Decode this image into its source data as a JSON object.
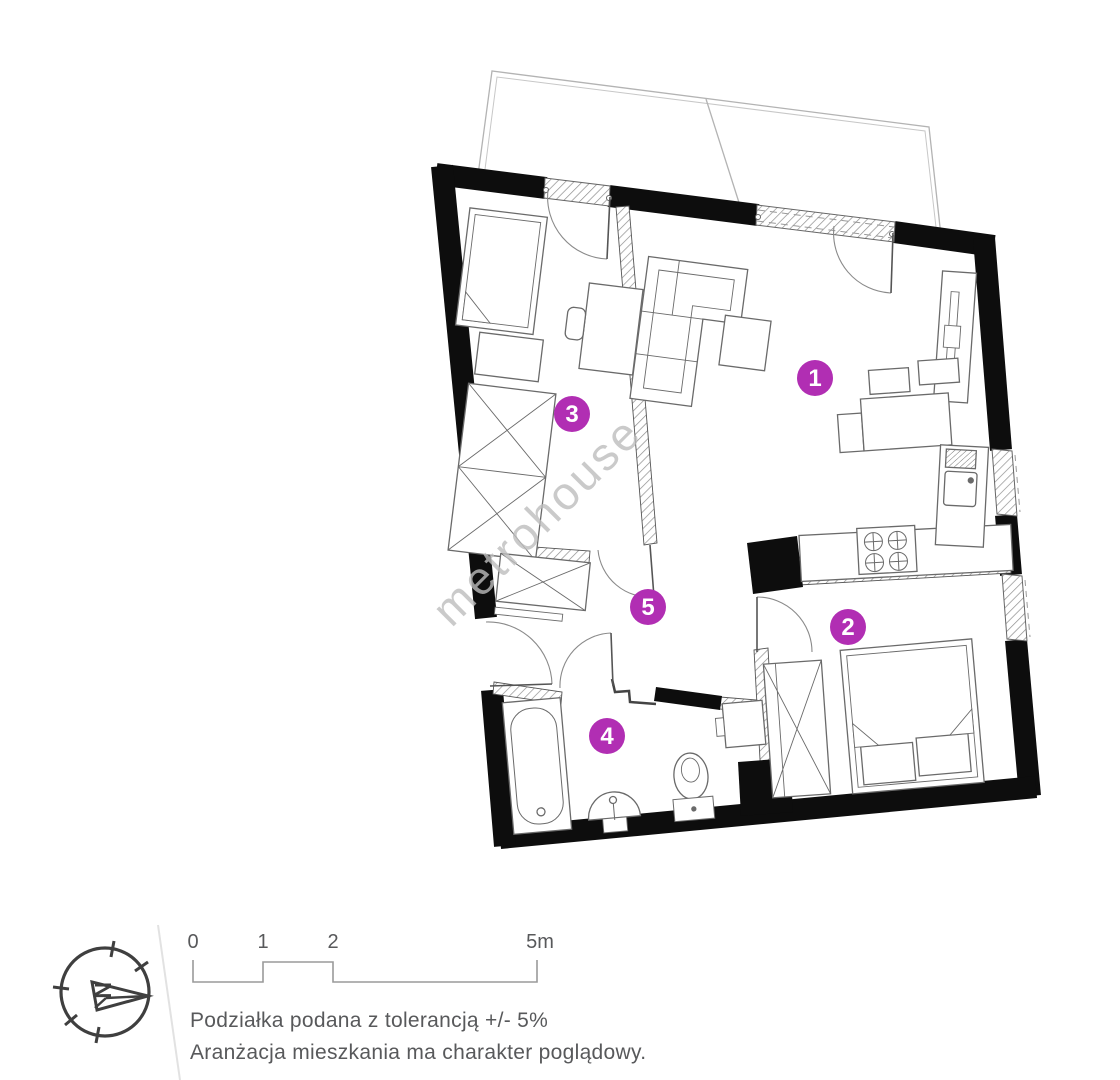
{
  "plan": {
    "type": "apartment-floor-plan",
    "rooms": [
      {
        "number": "1"
      },
      {
        "number": "2"
      },
      {
        "number": "3"
      },
      {
        "number": "4"
      },
      {
        "number": "5"
      }
    ]
  },
  "watermark_text": "metrohouse",
  "compass": {
    "north_label": "N"
  },
  "scale_bar": {
    "tick_labels": [
      "0",
      "1",
      "2",
      "5m"
    ]
  },
  "notes": {
    "line1": "Podziałka podana z tolerancją +/- 5%",
    "line2": "Aranżacja mieszkania ma charakter poglądowy."
  },
  "colors": {
    "badge": "#b12eb3",
    "badge_text": "#ffffff",
    "wall": "#0d0d0d",
    "watermark": "#bdbdbd",
    "text_muted": "#58595b"
  }
}
